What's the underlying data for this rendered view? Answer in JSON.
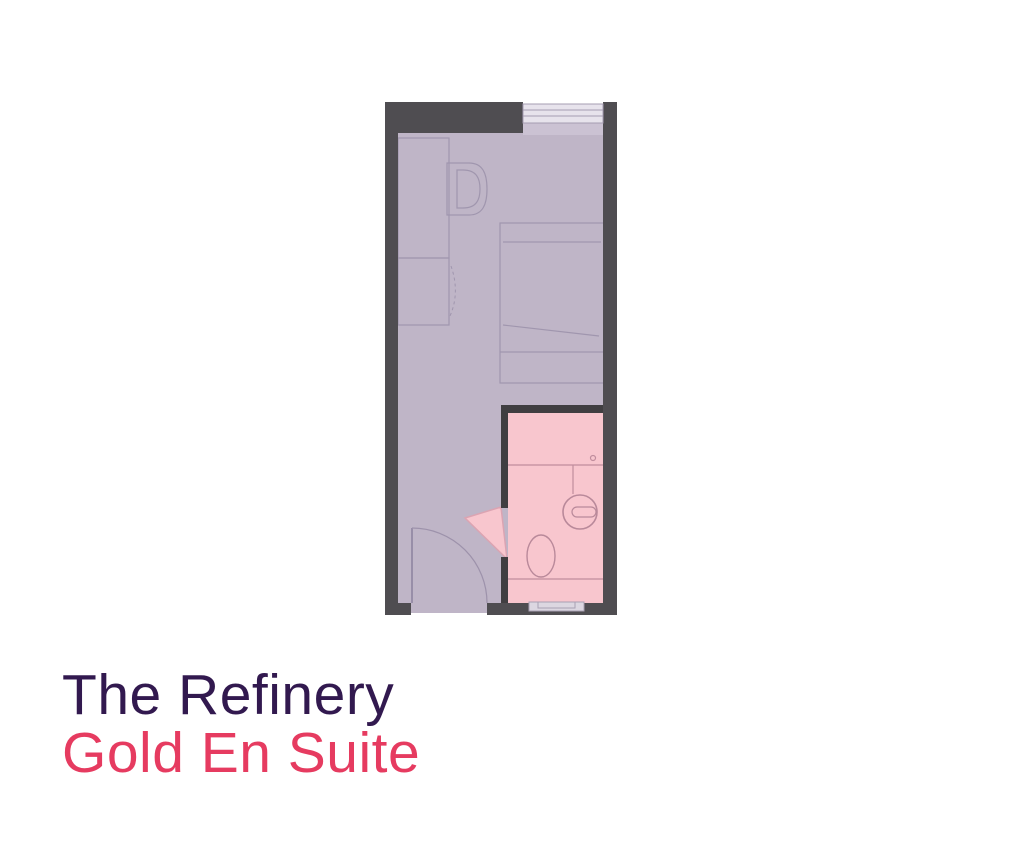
{
  "titles": {
    "building_name": "The Refinery",
    "room_type": "Gold En Suite"
  },
  "colors": {
    "background": "#ffffff",
    "wall_outer": "#4f4d51",
    "wall_inner": "#403e41",
    "floor": "#bfb5c7",
    "window_sill": "#cbc2d3",
    "window_glass": "#e7e3ec",
    "window_line": "#a59cb2",
    "ensuite": "#f8c6ce",
    "fixture_line": "#c08d9d",
    "furniture_line": "#a096ae",
    "door_line": "#8f84a1",
    "recess_fill": "#dcd7e1",
    "recess_line": "#a9a0b4",
    "title_primary": "#32194f",
    "title_accent": "#e63b60"
  },
  "floorplan": {
    "rooms": [
      "bedroom",
      "en-suite-bathroom"
    ],
    "elements": [
      "window",
      "desk",
      "chair",
      "wardrobe",
      "bed",
      "entrance-door",
      "bathroom-door",
      "shower",
      "sink",
      "toilet"
    ]
  }
}
